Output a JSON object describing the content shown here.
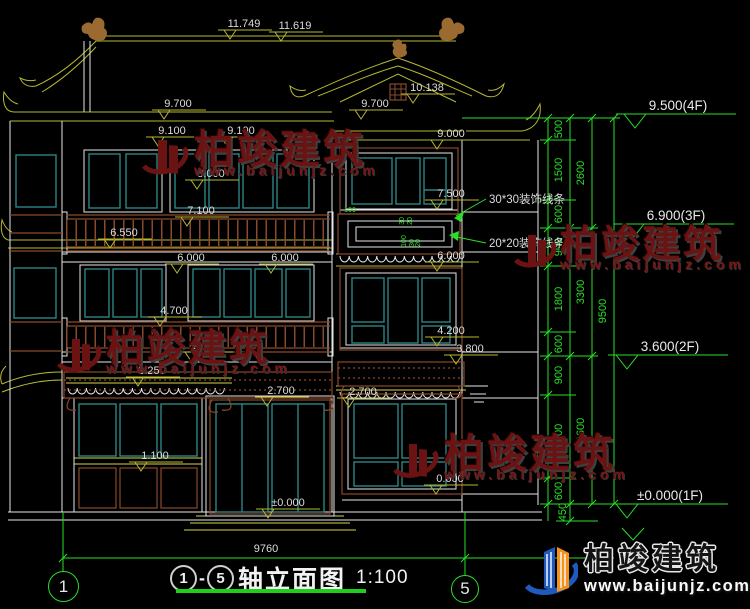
{
  "colors": {
    "bg": "#000000",
    "line_white": "#e6e6e6",
    "line_olive": "#b8b832",
    "line_yellow": "#d4d440",
    "line_green": "#2adf2a",
    "glazing_teal": "#2e8484",
    "frame_brown": "#8a4a2a",
    "dim_text": "#dcdcdc",
    "watermark_red": "#6b1313",
    "logo_blue": "#1f5abf",
    "logo_orange": "#f5921e"
  },
  "markers": [
    {
      "label": "11.749"
    },
    {
      "label": "11.619"
    },
    {
      "label": "10.138"
    },
    {
      "label": "9.700"
    },
    {
      "label": "9.700"
    },
    {
      "label": "9.100"
    },
    {
      "label": "9.100"
    },
    {
      "label": "9.000"
    },
    {
      "label": "8.000"
    },
    {
      "label": "7.500"
    },
    {
      "label": "7.100"
    },
    {
      "label": "6.550"
    },
    {
      "label": "6.000"
    },
    {
      "label": "6.000"
    },
    {
      "label": "6.000"
    },
    {
      "label": "4.700"
    },
    {
      "label": "4.200"
    },
    {
      "label": "3.800"
    },
    {
      "label": "3.800"
    },
    {
      "label": "3.250"
    },
    {
      "label": "2.700"
    },
    {
      "label": "2.700"
    },
    {
      "label": "1.100"
    },
    {
      "label": "0.600"
    },
    {
      "label": "±0.000"
    }
  ],
  "floor_markers": [
    {
      "label": "9.500(4F)"
    },
    {
      "label": "6.900(3F)"
    },
    {
      "label": "3.600(2F)"
    },
    {
      "label": "±0.000(1F)"
    }
  ],
  "chain_a": [
    "500",
    "1500",
    "600",
    "900",
    "1800",
    "600",
    "900",
    "2100",
    "600",
    "450"
  ],
  "chain_b": [
    "2600",
    "3300",
    "3600"
  ],
  "chain_c": [
    "9500"
  ],
  "callouts": [
    "30*30装饰线条",
    "20*20装饰线条"
  ],
  "panel_dims": [
    "100",
    "30",
    "20",
    "100",
    "30",
    "20"
  ],
  "bottom": {
    "overall_width": "9760"
  },
  "title_block": {
    "axis_start": "1",
    "separator": "-",
    "axis_end": "5",
    "name": "轴立面图",
    "scale": "1:100"
  },
  "grid_bubbles": [
    {
      "label": "1"
    },
    {
      "label": "5"
    }
  ],
  "watermark": {
    "brand": "柏竣建筑",
    "url": "www.baijunjz.com"
  },
  "logo": {
    "brand": "柏竣建筑",
    "url": "www.baijunjz.com"
  }
}
